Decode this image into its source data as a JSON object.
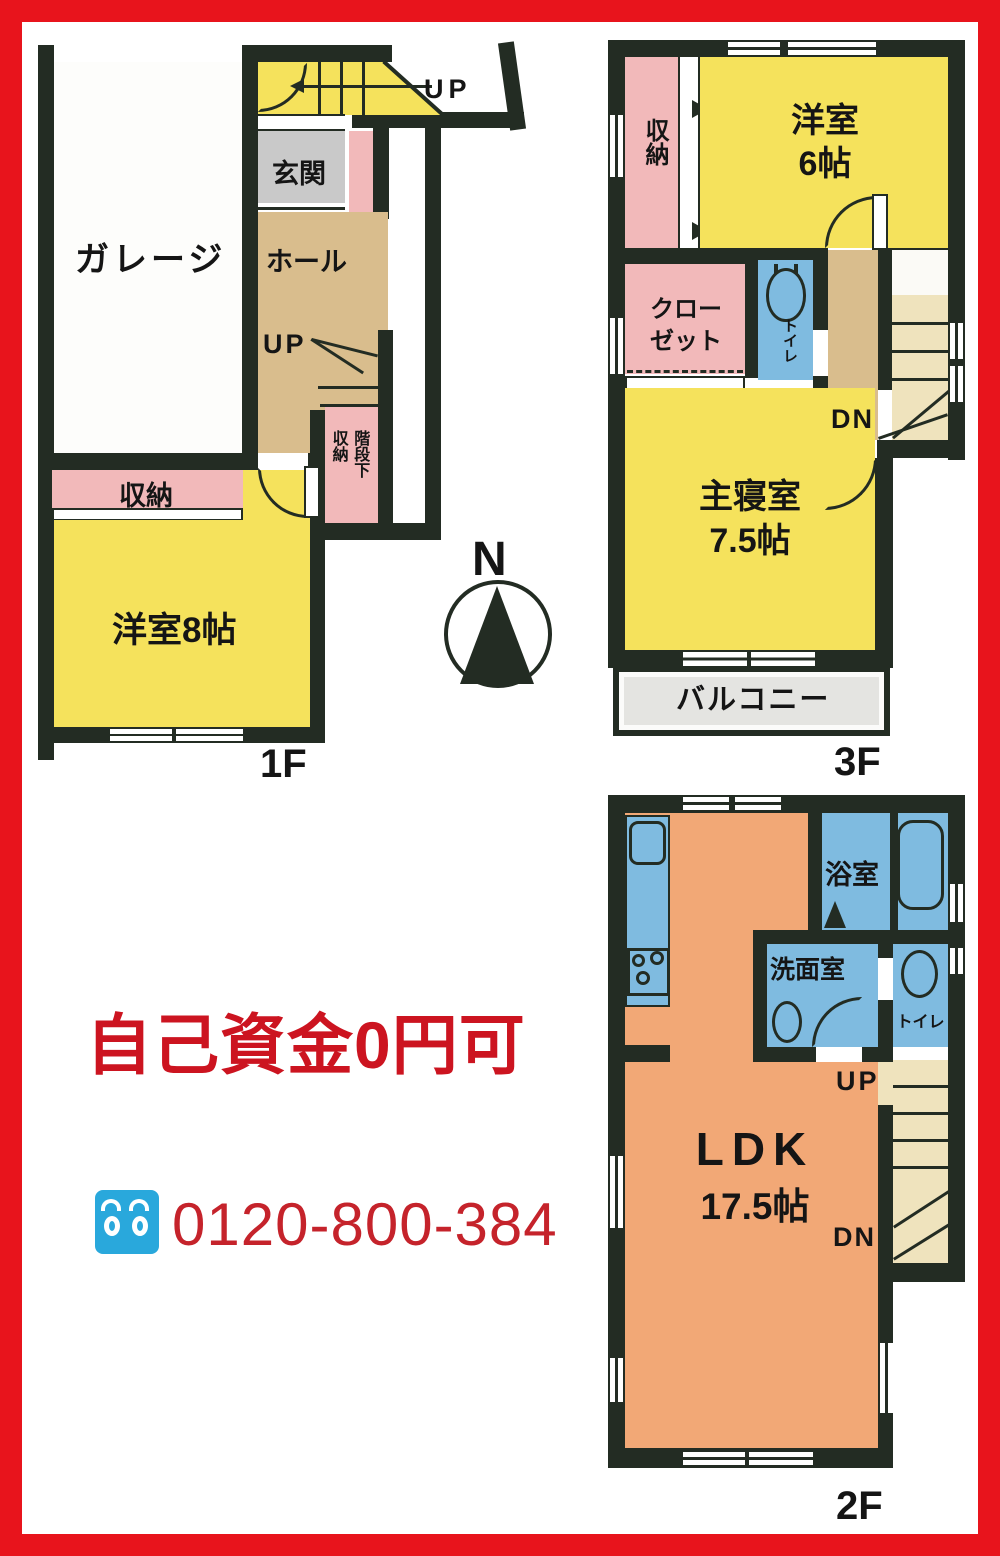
{
  "colors": {
    "frame_red": "#e8141c",
    "wall": "#232c23",
    "room_yellow": "#f5e25c",
    "room_pink": "#f2b9ba",
    "room_tan": "#d9bd8d",
    "room_gray": "#c9c9c9",
    "room_blue": "#7fbbe0",
    "room_orange": "#f2a876",
    "stair_cream": "#efe3bd",
    "balcony_gray": "#e4e4e1",
    "promo_red": "#cc1420",
    "phone_red": "#c5232b",
    "phone_icon_blue": "#29a8dc"
  },
  "floor1": {
    "garage": "ガレージ",
    "porch_up": "UP",
    "genkan": "玄関",
    "hall": "ホール",
    "stair_up": "UP",
    "under_stair_col1": "階段下",
    "under_stair_col2": "収納",
    "storage": "収納",
    "western_room": "洋室8帖",
    "floor_label": "1F"
  },
  "floor3": {
    "storage": "収納",
    "western_room": "洋室",
    "western_room_size": "6帖",
    "closet_line1": "クロー",
    "closet_line2": "ゼット",
    "toilet": "トイレ",
    "stair_dn": "DN",
    "master_bedroom": "主寝室",
    "master_bedroom_size": "7.5帖",
    "balcony": "バルコニー",
    "floor_label": "3F"
  },
  "floor2": {
    "bath": "浴室",
    "washroom": "洗面室",
    "toilet": "トイレ",
    "stair_up": "UP",
    "stair_dn": "DN",
    "ldk": "LDK",
    "ldk_size": "17.5帖",
    "floor_label": "2F"
  },
  "compass": {
    "north": "N"
  },
  "promo": {
    "text": "自己資金0円可"
  },
  "phone": {
    "number": "0120-800-384"
  }
}
